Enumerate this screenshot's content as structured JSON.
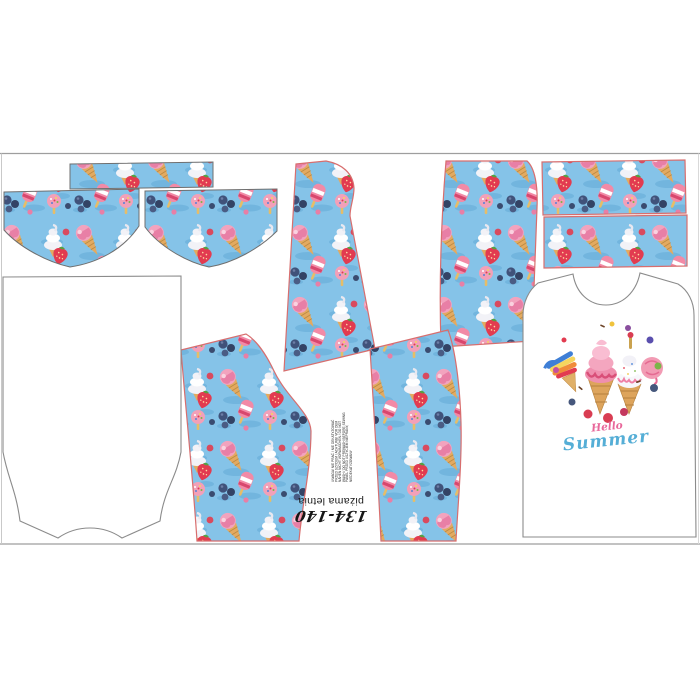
{
  "panel": {
    "size_label": "134-140",
    "product_label": "piżama letnia",
    "care_lines": [
      "UWAGA! NIE PRAĆ / NIE DEKATYZOWAĆ",
      "PRZED SZYCIEM / ACHTUNG! VOR DEM",
      "NÄHEN NICHT VORWASCHEN / DO NOT",
      "WASH / DO NOT PREWASH BEFORE SEWING",
      "PANEL PRZED USZYCIEM NIEPRANY,",
      "NIEDEKATYZOWANY"
    ],
    "shirt_graphic": {
      "hello": "Hello",
      "summer": "Summer"
    },
    "pieces": [
      "waistband-strip-left",
      "briefs-front-left",
      "briefs-front-right",
      "pant-leg-center",
      "pant-leg-upper-right",
      "waistband-strip-right-top",
      "waistband-strip-right-bottom",
      "pant-leg-lower-left",
      "pant-leg-lower-right",
      "shirt-back",
      "shirt-front"
    ],
    "colors": {
      "print_background": "#85c3e8",
      "piece_outline_pink": "#d86e6e",
      "piece_outline_gray": "#6f6f6f",
      "panel_border": "#9e9e9e",
      "hello_pink": "#e8679a",
      "summer_blue": "#55aed6"
    }
  }
}
